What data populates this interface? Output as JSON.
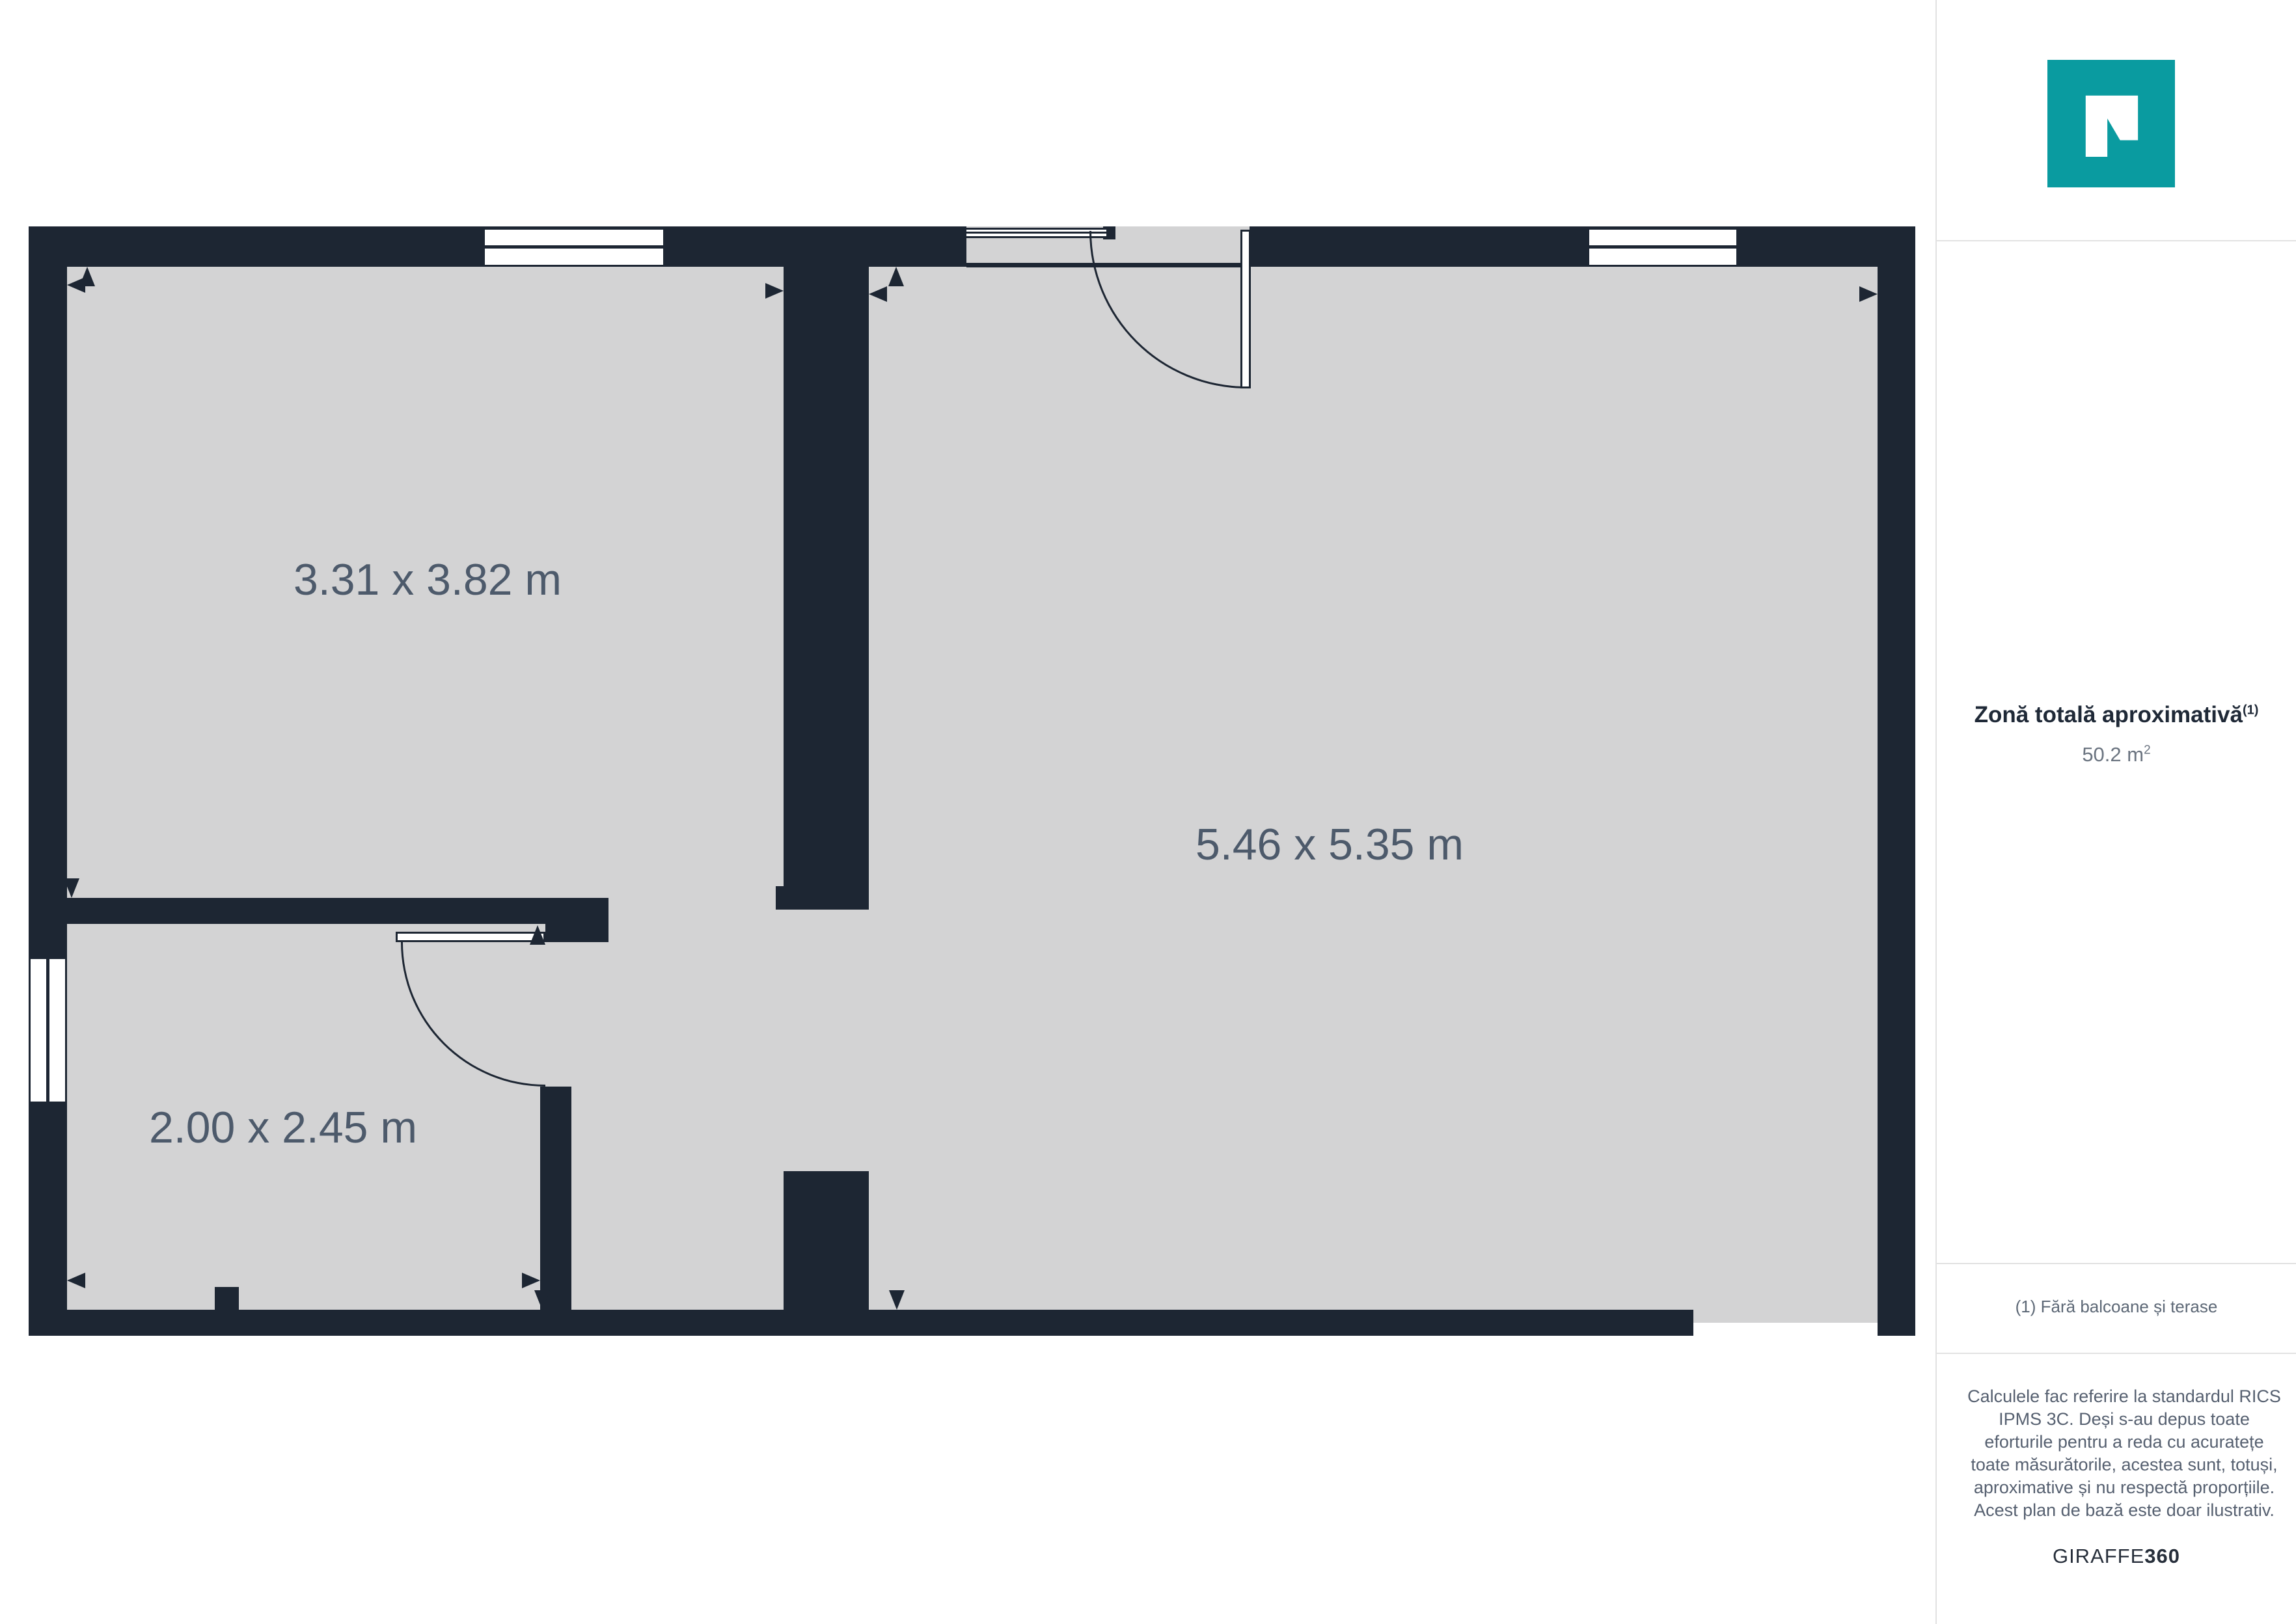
{
  "floor_plan": {
    "rooms": [
      {
        "id": "room-top-left",
        "label": "3.31 x 3.82 m"
      },
      {
        "id": "room-large-right",
        "label": "5.46 x 5.35 m"
      },
      {
        "id": "room-bottom-left",
        "label": "2.00 x 2.45 m"
      }
    ]
  },
  "sidebar": {
    "area_title": "Zonă totală aproximativă",
    "area_title_sup": "(1)",
    "area_value": "50.2 m",
    "area_value_sup": "2",
    "footnote": "(1) Fără balcoane și terase",
    "disclaimer": "Calculele fac referire la standardul RICS IPMS 3C. Deși s-au depus toate eforturile pentru a reda cu acuratețe toate măsurătorile, acestea sunt, totuși, aproximative și nu respectă proporțiile. Acest plan de bază este doar ilustrativ.",
    "brand": {
      "regular": "GIRAFFE",
      "bold": "360"
    }
  },
  "colors": {
    "wall": "#1D2633",
    "floor": "#D3D3D4",
    "room_label": "#4D5A6B",
    "logo_teal": "#0A9BA0",
    "heading_text": "#1F2937",
    "body_text": "#566070",
    "divider": "#E2E2E2"
  }
}
